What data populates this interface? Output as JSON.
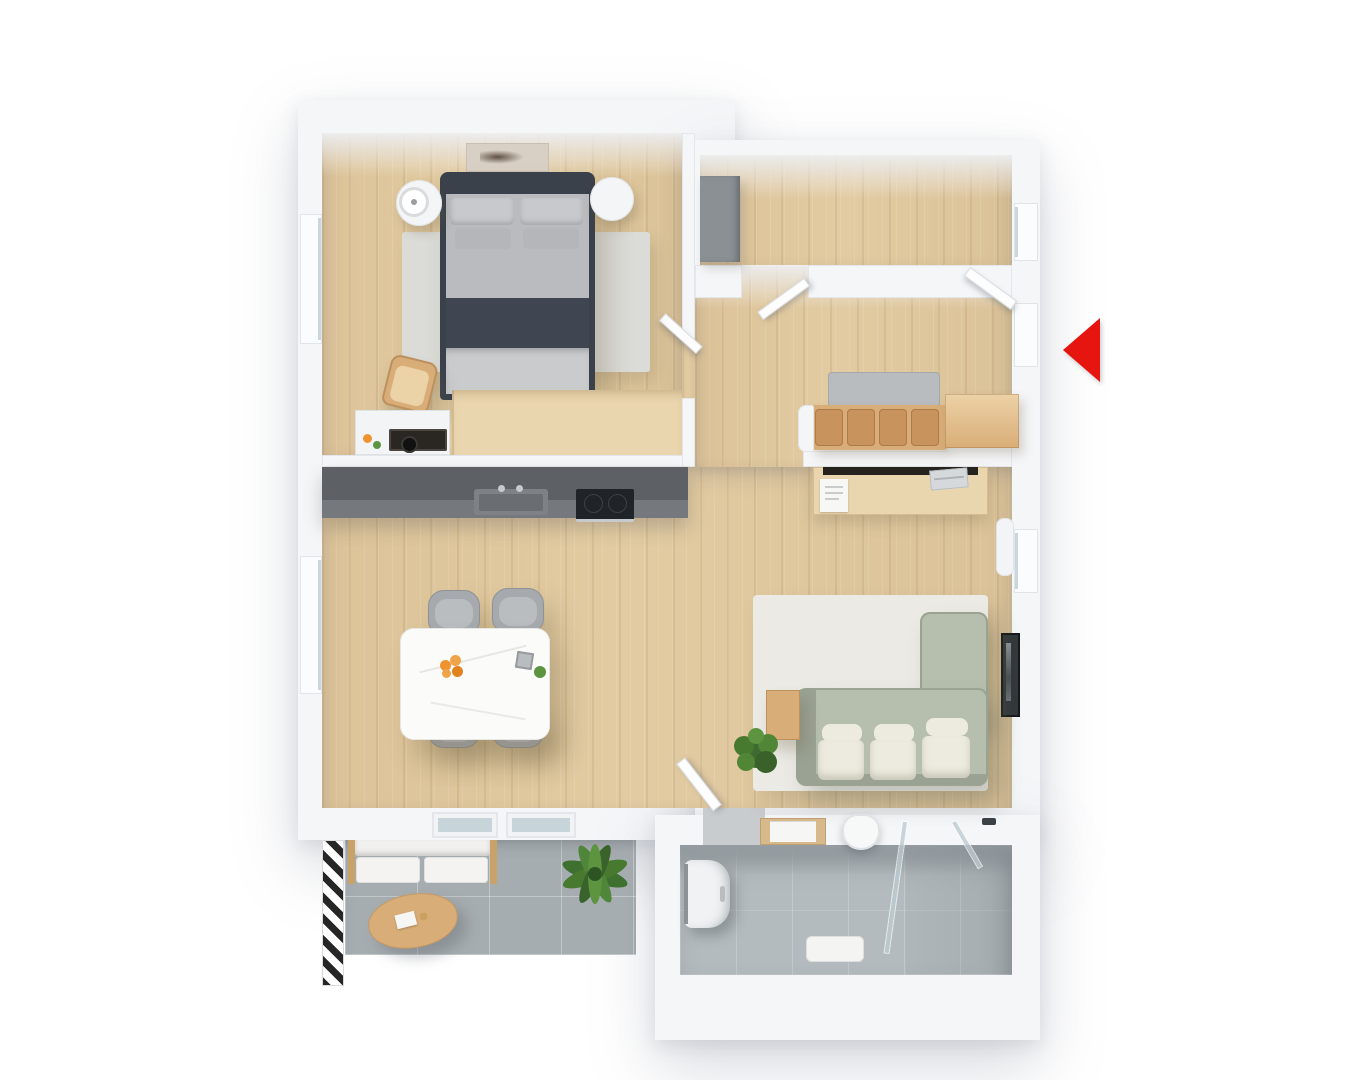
{
  "meta": {
    "kind": "3d-floor-plan-top-view",
    "background": "#ffffff",
    "description": "Top-down 3D rendered floor plan of a one-bedroom apartment with balcony; red arrow marks the entrance on the right side"
  },
  "colors": {
    "wall": "#f5f6f8",
    "wall_edge": "#e3e6ea",
    "wood": "#e2cba2",
    "wood_light": "#ead6ae",
    "counter_top": "#5d6166",
    "counter_front": "#75797e",
    "sink": "#7e8287",
    "sink_inner": "#6a6e73",
    "cooktop": "#202328",
    "steel": "#c6cacd",
    "bed_dark": "#3a414b",
    "bed_band": "#3f4651",
    "pillow": "#c7c9cc",
    "pillow2": "#b4b6ba",
    "duvet": "#b9bbbe",
    "duvet_light": "#c9cbcd",
    "rug_bed": "#dbdbd7",
    "rug_living": "#eceae5",
    "chair_gray": "#a6aaae",
    "chair_edge": "#8e9296",
    "table_white": "#fbfbfa",
    "sofa_green": "#b6beae",
    "sofa_green_dark": "#9aa294",
    "cushion_white": "#edebdf",
    "tan_wood": "#d9ad77",
    "tan_light": "#ecd2a7",
    "tan_cushion": "#c9935d",
    "gray_wardrobe": "#8b9095",
    "white_furn": "#f4f5f6",
    "tile_balcony": "#a6adb1",
    "tile_bath": "#b4bbbe",
    "bath_wall": "#959da2",
    "glass": "rgba(187,203,209,0.78)",
    "plant": "#47792f",
    "plant_light": "#5d9440",
    "arrow_red": "#e61510",
    "orange": "#ef9330",
    "dark_item": "#2a2723",
    "paper": "#f7f7f5"
  },
  "rooms": {
    "bedroom": {
      "label": "Bedroom",
      "furniture": [
        "double bed",
        "art above bed",
        "round nightstand with lamp",
        "round nightstand",
        "area rug",
        "armchair",
        "sideboard with stereo",
        "low wardrobe",
        "window",
        "door"
      ]
    },
    "storage": {
      "label": "Storage room",
      "furniture": [
        "grey wardrobe",
        "window",
        "door to hallway"
      ]
    },
    "hallway": {
      "label": "Entrance hall",
      "furniture": [
        "bench with seat cushions",
        "shoe cabinet",
        "entrance door"
      ]
    },
    "living": {
      "label": "Open-plan kitchen and living room",
      "furniture": [
        "kitchen counter with sink and cooktop",
        "dining table with four chairs",
        "console desk with laptop",
        "L-shaped green sofa",
        "area rug",
        "potted plant",
        "side table",
        "wall picture",
        "radiator",
        "windows",
        "balcony doors"
      ]
    },
    "balcony": {
      "label": "Balcony",
      "furniture": [
        "outdoor sofa",
        "oval coffee table",
        "palm plant",
        "striped railing strip"
      ]
    },
    "bathroom": {
      "label": "Bathroom",
      "furniture": [
        "washing machine",
        "shelf with towels",
        "wall-hung toilet",
        "bath mat",
        "walk-in glass shower"
      ]
    }
  },
  "markers": {
    "entrance": {
      "label": "Entrance",
      "shape": "red triangle pointing left"
    }
  }
}
